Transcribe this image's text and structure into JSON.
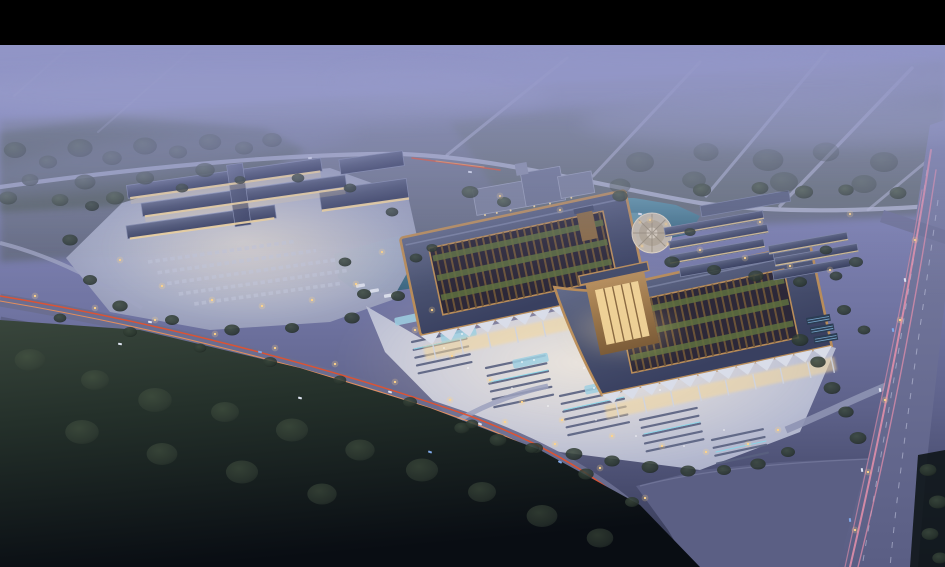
{
  "scene": {
    "alt": "Dusk aerial rendering of a large illuminated Chinese-style market complex: twin pavilion roofs with rooftop gardens, a bright forecourt plaza with stall rows, a secondary market cluster to the west, ponds, tree belts, a highway with red taillight trails and a wide avenue with pink light trails under purple evening haze",
    "time_of_day": "dusk"
  },
  "palette": {
    "letterbox": "#000000",
    "haze": "#8f93c4",
    "road_light": "#b7bbd6",
    "road_main": "#6a6e90",
    "north_road": "#a9aecb",
    "roof_slate": "#4a5270",
    "eave_copper": "#b98d5a",
    "lattice_brown": "#6f5638",
    "roof_garden": "#5f7040",
    "window_warm": "#f5d89c",
    "plaza_light": "#ced2e4",
    "stall_slate": "#596180",
    "stall_teal": "#86d8ea",
    "water_teal": "#4a7d92",
    "forest_dark": "#1a231f",
    "trail_red": "#e8502a",
    "trail_orange": "#ff9550",
    "trail_pink": "#e890ac",
    "lamp_warm": "#ffd489",
    "car_white": "#dfe4f2",
    "car_blue": "#7fa8e8"
  }
}
